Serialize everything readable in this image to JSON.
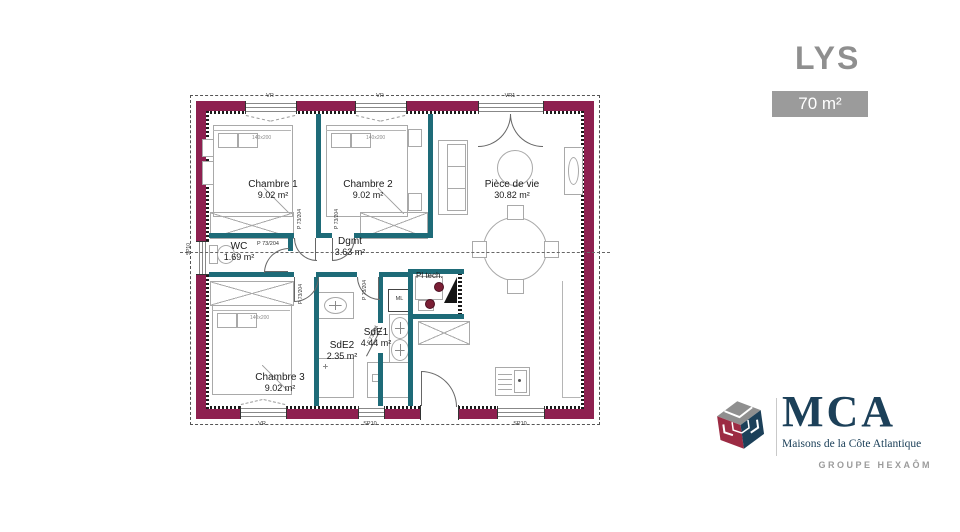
{
  "header": {
    "model_name": "LYS",
    "area_badge": "70 m²"
  },
  "plan": {
    "rooms": [
      {
        "id": "chambre1",
        "name": "Chambre 1",
        "area": "9.02 m²"
      },
      {
        "id": "chambre2",
        "name": "Chambre 2",
        "area": "9.02 m²"
      },
      {
        "id": "piece_de_vie",
        "name": "Pièce de vie",
        "area": "30.82 m²"
      },
      {
        "id": "dgmt",
        "name": "Dgmt",
        "area": "3.63 m²"
      },
      {
        "id": "wc",
        "name": "WC",
        "area": "1.69 m²"
      },
      {
        "id": "sde2",
        "name": "SdE2",
        "area": "2.35 m²"
      },
      {
        "id": "sde1",
        "name": "SdE1",
        "area": "4.44 m²"
      },
      {
        "id": "pl_tech",
        "name": "Pl tech."
      },
      {
        "id": "chambre3",
        "name": "Chambre 3",
        "area": "9.02 m²"
      }
    ],
    "bed_dim_label": "140x200",
    "door_label": "P 73/204",
    "window_labels": {
      "top_win1": "VR",
      "top_win2": "VR",
      "top_french_door": "VR1",
      "bottom_win1": "VR",
      "bottom_win2": "SP10",
      "bottom_win3": "SP10",
      "left_win": "SP10"
    },
    "appliance_labels": {
      "washing_machine": "ML"
    }
  },
  "logo": {
    "brand": "MCA",
    "subtitle": "Maisons de la Côte Atlantique",
    "group": "GROUPE HEXAÔM"
  },
  "colors": {
    "exterior_wall": "#8e2050",
    "partition": "#1e6b78",
    "title_gray": "#8f8f8f",
    "badge_gray": "#9b9b9b",
    "logo_navy": "#1c4059",
    "logo_red": "#9c2b43",
    "logo_gray": "#8f8f8f"
  }
}
